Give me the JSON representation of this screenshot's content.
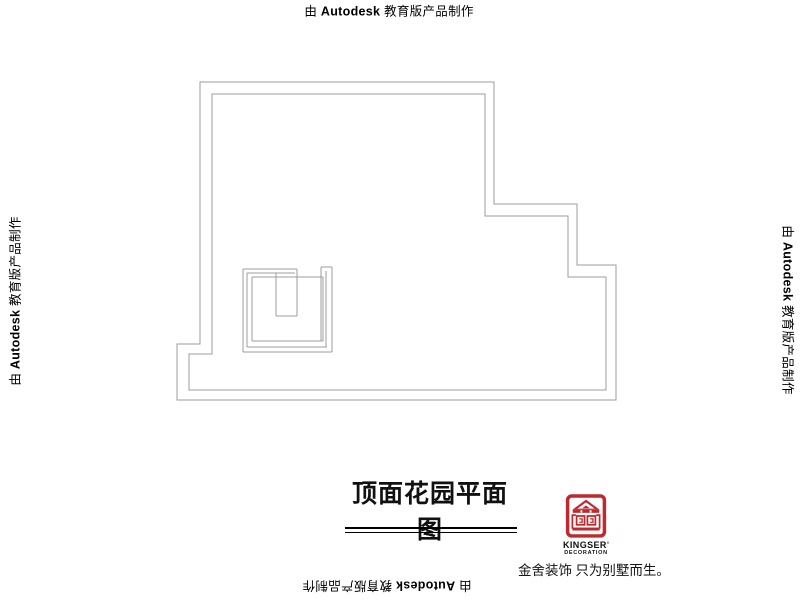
{
  "watermark": {
    "prefix": "由",
    "brand": "Autodesk",
    "suffix": "教育版产品制作"
  },
  "title_block": {
    "title": "顶面花园平面图"
  },
  "plan": {
    "outline_outer_points": "200,82 494,82 494,204 577,204 577,265 616,265 616,400 177,400 177,344 200,344",
    "outline_inner_points": "212,94 485,94 485,216 568,216 568,277 606,277 606,390 189,390 189,354 212,354",
    "stair_segments": [
      "M243 269 H297",
      "M247 273 H295",
      "M243 269 V352",
      "M247 273 V347",
      "M243 352 H332",
      "M247 347 H327",
      "M332 267 V352",
      "M326 271 V347",
      "M321 267 V341",
      "M321 267 H332",
      "M252 277 H323",
      "M252 277 V341",
      "M252 341 H323",
      "M323 277 V341",
      "M276 273 V316",
      "M297 269 V316",
      "M276 316 H297"
    ]
  },
  "logo": {
    "brand": "KINGSER",
    "mark": "'",
    "subtitle": "DECORATION",
    "tagline": "金舍装饰 只为别墅而生。"
  },
  "colors": {
    "plan_line": "#9d9d9d",
    "logo_red": "#bf282d",
    "text": "#000000"
  }
}
